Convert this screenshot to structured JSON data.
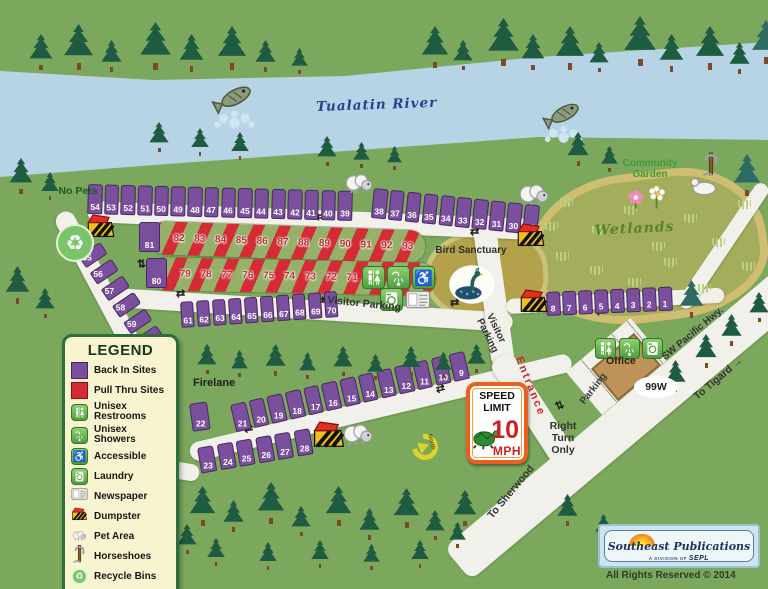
{
  "labels": {
    "river": "Tualatin River",
    "no_pets": "No Pets",
    "community_garden": "Community Garden",
    "wetlands": "Wetlands",
    "bird_sanctuary": "Bird Sanctuary",
    "visitor_parking": "Visitor Parking",
    "firelane": "Firelane",
    "entrance": "Entrance",
    "right_turn_only": "Right Turn Only",
    "parking": "Parking",
    "office": "Office",
    "hwy_shield": "99W",
    "sw_pacific_hwy": "SW Pacific Hwy.",
    "to_tigard": "To Tigard →",
    "to_sherwood": "To Sherwood",
    "north": "North"
  },
  "speed_sign": {
    "line1": "SPEED",
    "line2": "LIMIT",
    "value": "10",
    "unit": "MPH"
  },
  "legend": {
    "title": "LEGEND",
    "items": [
      {
        "icon": "backin-swatch-icon",
        "label": "Back In Sites"
      },
      {
        "icon": "pullthru-swatch-icon",
        "label": "Pull Thru Sites"
      },
      {
        "icon": "restroom-icon",
        "label": "Unisex Restrooms"
      },
      {
        "icon": "shower-icon",
        "label": "Unisex Showers"
      },
      {
        "icon": "accessible-icon",
        "label": "Accessible"
      },
      {
        "icon": "laundry-icon",
        "label": "Laundry"
      },
      {
        "icon": "newspaper-icon",
        "label": "Newspaper"
      },
      {
        "icon": "dumpster-icon",
        "label": "Dumpster"
      },
      {
        "icon": "pet-icon",
        "label": "Pet Area"
      },
      {
        "icon": "horseshoes-icon",
        "label": "Horseshoes"
      },
      {
        "icon": "recycle-icon",
        "label": "Recycle Bins"
      }
    ]
  },
  "sites": {
    "row_top_a": [
      "54",
      "53",
      "52",
      "51",
      "50",
      "49",
      "48",
      "47",
      "46",
      "45",
      "44",
      "43",
      "42",
      "41",
      "40",
      "39"
    ],
    "row_top_b": [
      "38",
      "37",
      "36",
      "35",
      "34",
      "33",
      "32",
      "31",
      "30",
      "29"
    ],
    "pullthru_row1": {
      "head": "81",
      "numbers": [
        "82",
        "83",
        "84",
        "85",
        "86",
        "87",
        "88",
        "89",
        "90",
        "91",
        "92",
        "93"
      ]
    },
    "pullthru_row2": {
      "head": "80",
      "numbers": [
        "79",
        "78",
        "77",
        "76",
        "75",
        "74",
        "73",
        "72",
        "71"
      ]
    },
    "left_col": [
      "55",
      "56",
      "57",
      "58",
      "59",
      "60"
    ],
    "row_mid": [
      "61",
      "62",
      "63",
      "64",
      "65",
      "66",
      "67",
      "68",
      "69",
      "70"
    ],
    "row_lower": [
      "21",
      "20",
      "19",
      "18",
      "17",
      "16",
      "15",
      "14",
      "13",
      "12",
      "11",
      "10",
      "9"
    ],
    "site_22": "22",
    "row_bottom": [
      "23",
      "24",
      "25",
      "26",
      "27",
      "28"
    ],
    "row_right": [
      "8",
      "7",
      "6",
      "5",
      "4",
      "3",
      "2",
      "1"
    ]
  },
  "icons": {
    "recycle_glyph": "♻",
    "accessible_glyph": "♿",
    "road_arrow_glyph": "⇄"
  },
  "colors": {
    "back_in": "#7a4f9d",
    "pull_thru": "#d42b35",
    "grass": "#7ca85d",
    "river": "#b7d4e6",
    "road": "#f2f0ea",
    "legend_bg": "#f8f4cf",
    "wetlands_border": "#cfbd72",
    "entrance_red": "#cf2727"
  },
  "footer": {
    "logo_name": "Southeast Publications",
    "division": "A DIVISION OF",
    "division_brand": "SEPL",
    "rights": "All Rights Reserved © 2014"
  }
}
